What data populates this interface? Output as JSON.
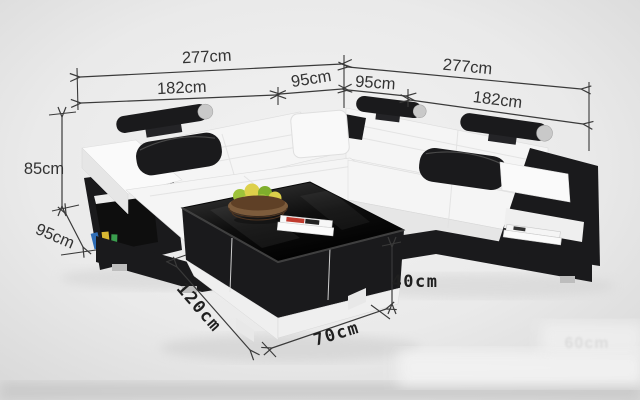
{
  "image": {
    "description": "Dimension diagram of an L-shaped white leather sectional sofa with black accents, black headrest rolls and pillows, storage arms, and a black coffee table with fruit basket and magazines",
    "background_color": "#e9e9e9"
  },
  "dimensions": {
    "left_total_width": "277cm",
    "left_seat_width": "182cm",
    "left_corner_width": "95cm",
    "right_corner_width": "95cm",
    "right_seat_width": "182cm",
    "right_total_width": "277cm",
    "back_height": "85cm",
    "seat_depth": "95cm",
    "table_length": "120cm",
    "table_width": "70cm",
    "table_height": "40cm",
    "faded_watermark": "60cm"
  },
  "objects": {
    "sofa": "sectional-sofa",
    "table": "coffee-table",
    "basket": "fruit-basket",
    "magazines": "magazines",
    "books": "shelf-books"
  },
  "colors": {
    "dimension_line": "#3a3a3a",
    "dimension_text": "#333333",
    "bold_dimension_text": "#1f1f1f",
    "sofa_white": "#f5f5f5",
    "sofa_white_shade": "#e6e6e6",
    "sofa_black": "#1a1a1c",
    "table_top": "#141414",
    "table_plinth": "#efefef",
    "basket_brown": "#7d5c3c",
    "basket_inner": "#5f4026",
    "fruit_green": "#9dc23a",
    "fruit_green_dark": "#7fae2c",
    "fruit_yellow": "#ddd04a",
    "book_blue": "#2f6db5",
    "book_yellow": "#d8b832",
    "book_green": "#3a9e4e",
    "magazine_red": "#c03a2e"
  }
}
